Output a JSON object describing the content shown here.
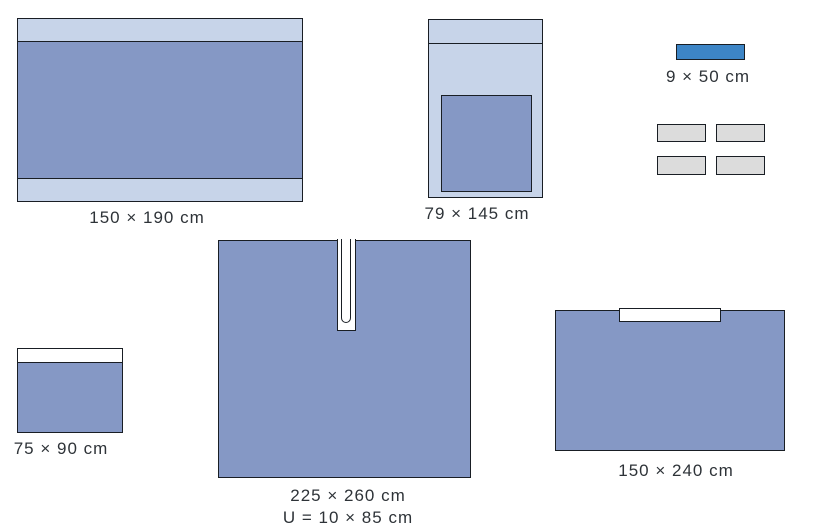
{
  "palette": {
    "page_bg": "#ffffff",
    "drape_blue": "#8598c5",
    "light_blue": "#c7d4e9",
    "tape_blue": "#3d85c6",
    "towel_gray": "#dcdcdc",
    "outline": "#191e24",
    "label_color": "#2e3338"
  },
  "items": {
    "drape_150x190": {
      "label": "150 × 190 cm"
    },
    "drape_79x145": {
      "label": "79 × 145 cm"
    },
    "tape_9x50": {
      "label": "9 × 50 cm"
    },
    "towels": {
      "count": 4
    },
    "drape_75x90": {
      "label": "75 × 90 cm"
    },
    "u_drape_225x260": {
      "label": "225 × 260 cm",
      "u_label": "U = 10 × 85 cm"
    },
    "drape_150x240": {
      "label": "150 × 240 cm"
    }
  }
}
